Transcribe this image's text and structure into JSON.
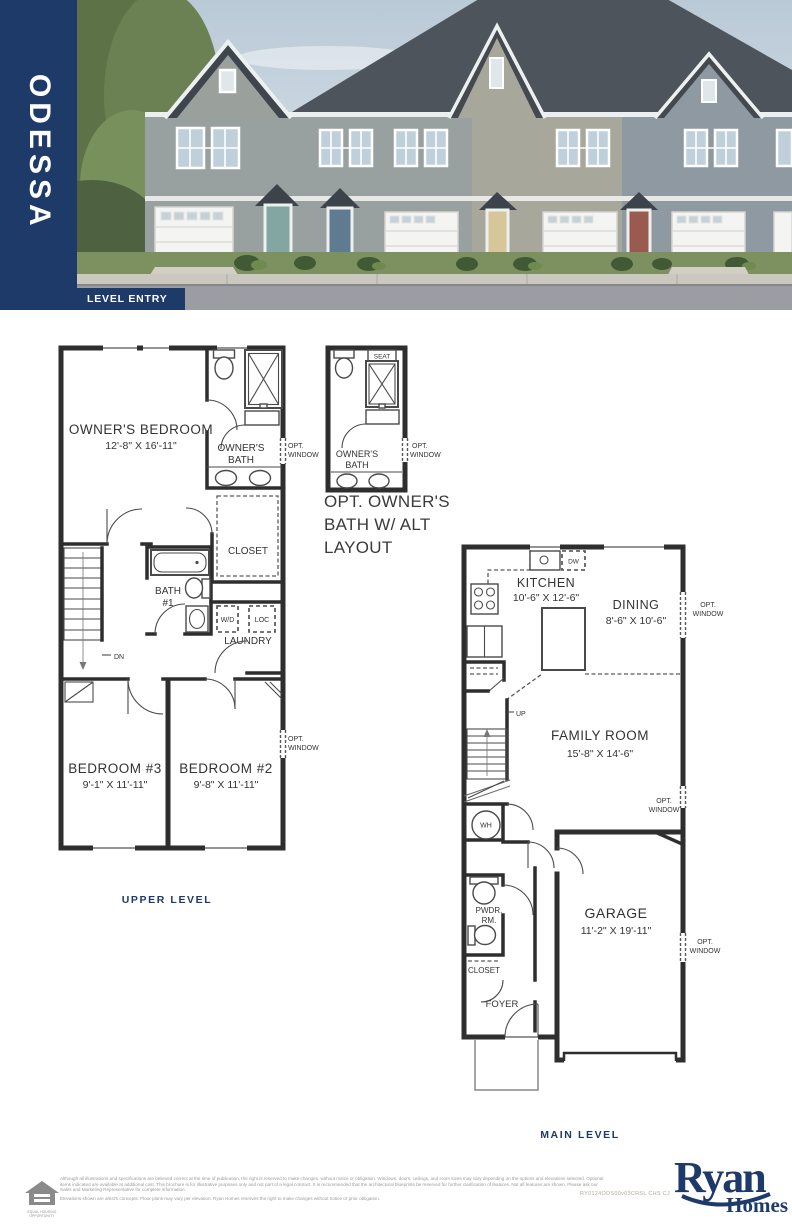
{
  "header": {
    "model_name": "ODESSA",
    "banner_label": "LEVEL ENTRY"
  },
  "upper_plan": {
    "caption": "UPPER LEVEL",
    "owners_bedroom_name": "OWNER'S BEDROOM",
    "owners_bedroom_dim": "12'-8\" X 16'-11\"",
    "owners_bath_line1": "OWNER'S",
    "owners_bath_line2": "BATH",
    "opt_window_bath_line1": "OPT.",
    "opt_window_bath_line2": "WINDOW",
    "closet": "CLOSET",
    "bath1_line1": "BATH",
    "bath1_line2": "#1",
    "wd": "W/D",
    "loc": "LOC",
    "laundry": "LAUNDRY",
    "dn": "DN",
    "bedroom3_name": "BEDROOM #3",
    "bedroom3_dim": "9'-1\" X 11'-11\"",
    "bedroom2_name": "BEDROOM #2",
    "bedroom2_dim": "9'-8\" X 11'-11\"",
    "opt_window_bed2_line1": "OPT.",
    "opt_window_bed2_line2": "WINDOW"
  },
  "opt_bath": {
    "seat": "SEAT",
    "owners_bath_line1": "OWNER'S",
    "owners_bath_line2": "BATH",
    "opt_window_line1": "OPT.",
    "opt_window_line2": "WINDOW",
    "caption_line1": "OPT. OWNER'S",
    "caption_line2": "BATH W/ ALT",
    "caption_line3": "LAYOUT"
  },
  "main_plan": {
    "caption": "MAIN LEVEL",
    "kitchen_name": "KITCHEN",
    "kitchen_dim": "10'-6\" X 12'-6\"",
    "dw": "DW",
    "dining_name": "DINING",
    "dining_dim": "8'-6\" X 10'-6\"",
    "opt_window_dining_line1": "OPT.",
    "opt_window_dining_line2": "WINDOW",
    "up": "UP",
    "family_name": "FAMILY ROOM",
    "family_dim": "15'-8\" X 14'-6\"",
    "opt_window_family_line1": "OPT.",
    "opt_window_family_line2": "WINDOW",
    "wh": "WH",
    "garage_name": "GARAGE",
    "garage_dim": "11'-2\" X 19'-11\"",
    "opt_window_garage_line1": "OPT.",
    "opt_window_garage_line2": "WINDOW",
    "pwdr_line1": "PWDR.",
    "pwdr_line2": "RM.",
    "closet": "CLOSET",
    "foyer": "FOYER"
  },
  "footer": {
    "disclaimer_line1": "Although all illustrations and specifications are believed correct at the time of publication, the right is reserved to make changes, without notice or obligation. Windows, doors, ceilings, and room sizes may vary depending on the options and elevations selected. Optional items indicated are available at additional cost. This brochure is for illustrative purposes only and not part of a legal contract. It is recommended that the architectural blueprints be reserved for further clarification of features. Not all features are shown. Please ask our Sales and Marketing Representative for complete information.",
    "disclaimer_line2": "Elevations shown are artist's concepts. Floor plans may vary per elevation. Ryan Homes reserves the right to make changes without notice or prior obligation.",
    "plan_code": "RY0124ODS00v03CRSL CHS CJ",
    "eho_line1": "EQUAL HOUSING",
    "eho_line2": "OPPORTUNITY",
    "brand_top": "Ryan",
    "brand_bottom": "Homes"
  },
  "colors": {
    "navy": "#1d3a68",
    "plan_line": "#2e2e2e"
  }
}
